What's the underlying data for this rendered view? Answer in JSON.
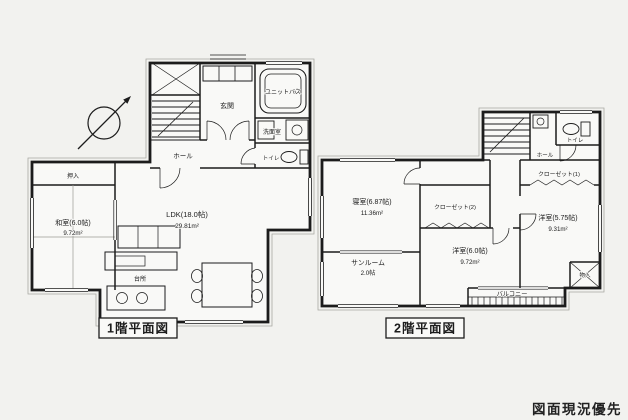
{
  "page": {
    "caption": "図面現況優先"
  },
  "colors": {
    "ink": "#1c1c1c",
    "paper": "#f2f2ef",
    "room_fill": "#f9f9f7"
  },
  "floor1": {
    "title": "1階平面図",
    "labels": {
      "genkan": "玄関",
      "hall": "ホール",
      "unit_bath": "ユニットバス",
      "washroom": "洗面室",
      "toilet": "トイレ",
      "oshiire": "押入",
      "washitsu": "和室(6.0帖)",
      "washitsu_area": "9.72m²",
      "ldk": "LDK(18.0帖)",
      "ldk_area": "29.81m²",
      "kitchen": "台所"
    }
  },
  "floor2": {
    "title": "2階平面図",
    "labels": {
      "bedroom": "寝室(6.87帖)",
      "bedroom_area": "11.36m²",
      "sunroom": "サンルーム",
      "sunroom_size": "2.0帖",
      "closet1": "クローゼット(1)",
      "closet2": "クローゼット(2)",
      "west_room": "洋室(6.0帖)",
      "west_room_area": "9.72m²",
      "east_room": "洋室(5.75帖)",
      "east_room_area": "9.31m²",
      "balcony": "バルコニー",
      "storage": "物入",
      "toilet": "トイレ",
      "hall": "ホール"
    }
  }
}
